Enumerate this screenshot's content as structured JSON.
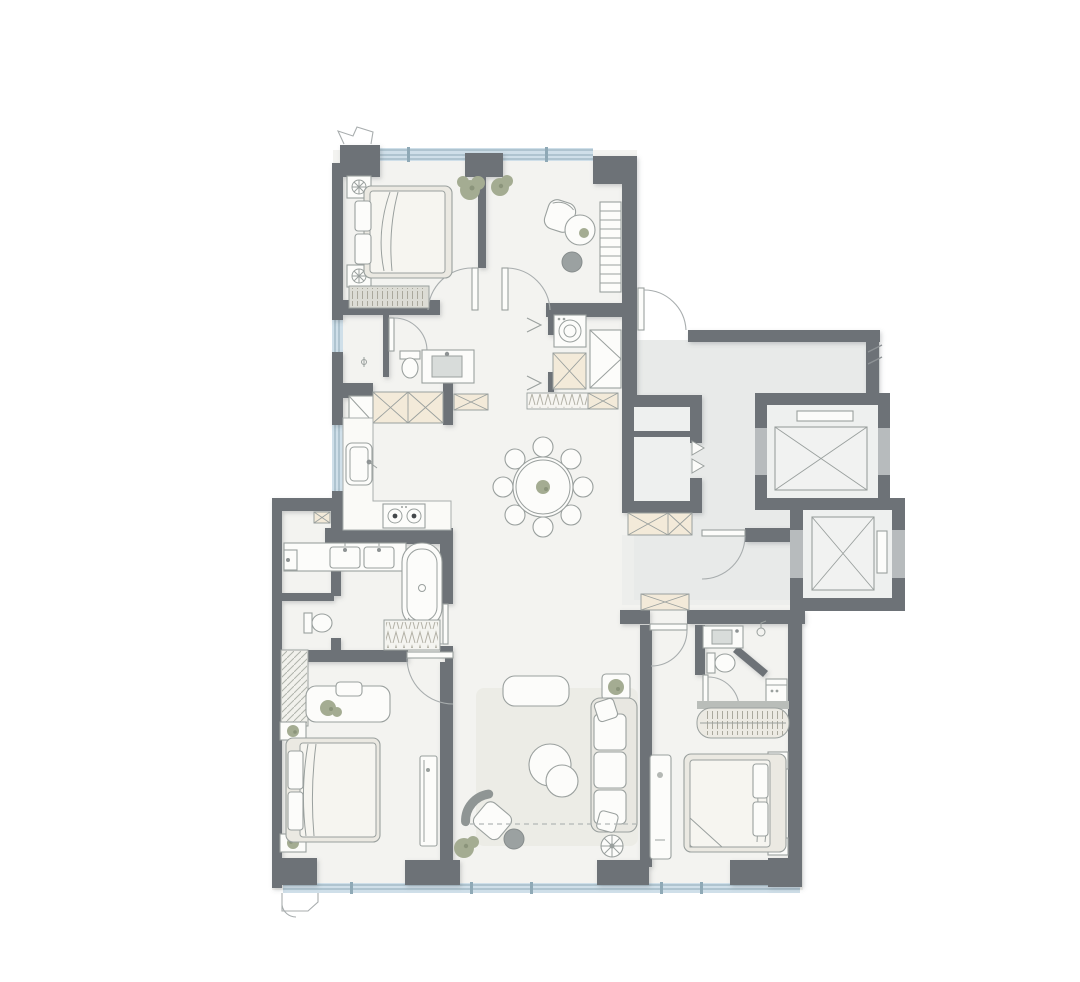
{
  "page": {
    "title": "apartment-floor-plan",
    "background": "#ffffff"
  },
  "plan": {
    "type": "residential-floor-plan",
    "visible_text": [],
    "colors": {
      "wall": "#6d7277",
      "wallLight": "#b7bbbd",
      "floor": "#f3f3f0",
      "lobbyFloor": "#e8eae9",
      "window": "#cfdfe9",
      "windowLine": "#8fa9b6",
      "furnitureFill": "#fcfcfa",
      "furnitureStroke": "#9aa09e",
      "softFill": "#edece6",
      "beige": "#f3ead9",
      "rug": "#ecece6",
      "shaft": "#eef0ef",
      "object": "#9ba1a1",
      "basin": "#d8dcda",
      "duvet": "#f6f5f0",
      "frame": "#ebe9e2",
      "plant": "#a4ac92",
      "plantDark": "#8b947b"
    },
    "rooms": [
      {
        "name": "bedroom-1",
        "position": "top-left",
        "furniture": [
          "double-bed",
          "nightstand",
          "nightstand",
          "dresser-bench",
          "window-band"
        ]
      },
      {
        "name": "study",
        "position": "top-right",
        "furniture": [
          "desk-chair",
          "round-table",
          "stool",
          "bookshelf",
          "plants"
        ]
      },
      {
        "name": "hall-bathroom",
        "position": "mid-left",
        "furniture": [
          "toilet",
          "basin-counter",
          "door"
        ]
      },
      {
        "name": "laundry-closet",
        "position": "center",
        "furniture": [
          "washing-machine",
          "duct-shaft",
          "cabinet",
          "bifold-doors"
        ]
      },
      {
        "name": "entry-hall",
        "position": "center-right",
        "furniture": [
          "coat-rack",
          "shoe-cabinet",
          "shoe-cabinet",
          "storage-closet-double-doors",
          "entry-door"
        ]
      },
      {
        "name": "kitchen-open",
        "position": "mid-left",
        "furniture": [
          "sink",
          "cooktop-2-burner",
          "l-shaped-counter",
          "tall-cabinets-crosshatch"
        ]
      },
      {
        "name": "dining-open",
        "position": "center",
        "furniture": [
          "round-dining-table",
          "dining-chairs-x8",
          "table-plant"
        ]
      },
      {
        "name": "living-room",
        "position": "bottom-center",
        "furniture": [
          "rug",
          "sofa",
          "cushions",
          "coffee-table-round",
          "coffee-table-round",
          "tv-console",
          "lounge-chair",
          "ottoman",
          "floor-lamp",
          "side-table-plant"
        ]
      },
      {
        "name": "master-bathroom",
        "position": "mid-left-lower",
        "furniture": [
          "double-vanity",
          "bathtub",
          "linen-bench"
        ]
      },
      {
        "name": "wc-2",
        "position": "left-lower",
        "furniture": [
          "toilet"
        ]
      },
      {
        "name": "utility-room",
        "position": "left-lower",
        "furniture": [
          "basin",
          "vent-shaft",
          "window"
        ]
      },
      {
        "name": "bedroom-2",
        "position": "bottom-left",
        "furniture": [
          "double-bed",
          "nightstand",
          "nightstand",
          "wardrobe-hatched",
          "desk",
          "chair",
          "tv-bench",
          "plant"
        ]
      },
      {
        "name": "bedroom-3-suite",
        "position": "bottom-right",
        "furniture": [
          "double-bed",
          "nightstand",
          "nightstand",
          "sliding-wardrobe",
          "low-bench",
          "mini-fridge",
          "ensuite-toilet",
          "ensuite-vanity",
          "corner-shower"
        ]
      },
      {
        "name": "elevator-lobby",
        "position": "right",
        "furniture": [
          "elevator-shaft-1",
          "elevator-shaft-2",
          "stair-door",
          "break-line-symbol"
        ]
      }
    ],
    "core": {
      "elevators": 2,
      "elevator_symbol": "crossed-box-car-in-shaft",
      "storage_closet_double_doors": 2
    },
    "symbols": {
      "walls": "dark-gray-filled",
      "windows": "light-blue-band-with-mullions",
      "doors": "quarter-arc-swing",
      "shafts_cabinets": "beige-crosshatch-box",
      "soft_divider": "dashed-line-living-room"
    },
    "counts": {
      "dining_chairs": 8,
      "bedrooms": 3,
      "bathrooms": 3,
      "windows_bottom_piers": 4
    }
  }
}
